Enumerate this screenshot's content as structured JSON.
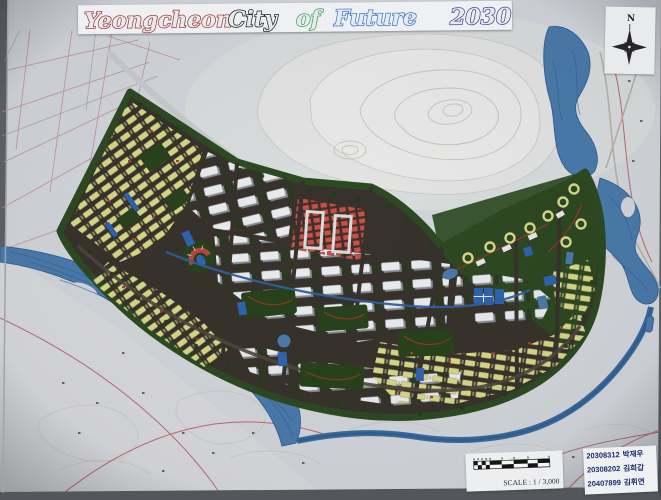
{
  "photo": {
    "background": "#5f6266",
    "paper": "#d3d6db"
  },
  "banner": {
    "segments": [
      {
        "text": "Yeongcheon",
        "color": "#9e3a33"
      },
      {
        "text": "City",
        "color": "#1f1f1f"
      },
      {
        "text": "of",
        "color": "#3f9e59"
      },
      {
        "text": "Future",
        "color": "#3b77c4"
      },
      {
        "text": "2030",
        "color": "#4a3f9d"
      }
    ]
  },
  "compass": {
    "label": "N"
  },
  "scale_card": {
    "label": "SCALE : 1 / 3,000"
  },
  "credits": {
    "text_color": "#1f2d6e",
    "lines": [
      {
        "id": "20308312",
        "name": "박재우"
      },
      {
        "id": "20308202",
        "name": "김희갑"
      },
      {
        "id": "20407899",
        "name": "김휘연"
      }
    ]
  },
  "map": {
    "colors": {
      "road_dark": "#37322b",
      "housing_yellow": "#d8d888",
      "apartment_white": "#e9ebee",
      "apartment_shadow": "#84878c",
      "commercial_red": "#c4524a",
      "public_blue": "#2e63b0",
      "park_green": "#26421c",
      "forest_green": "#2c4a22",
      "river_blue": "#4a7aab",
      "river_edge": "#2d5c90",
      "terrain_white": "#e9eae9",
      "contour_line": "#c9c5bb",
      "cadastral_pink": "#bd8a93"
    }
  }
}
